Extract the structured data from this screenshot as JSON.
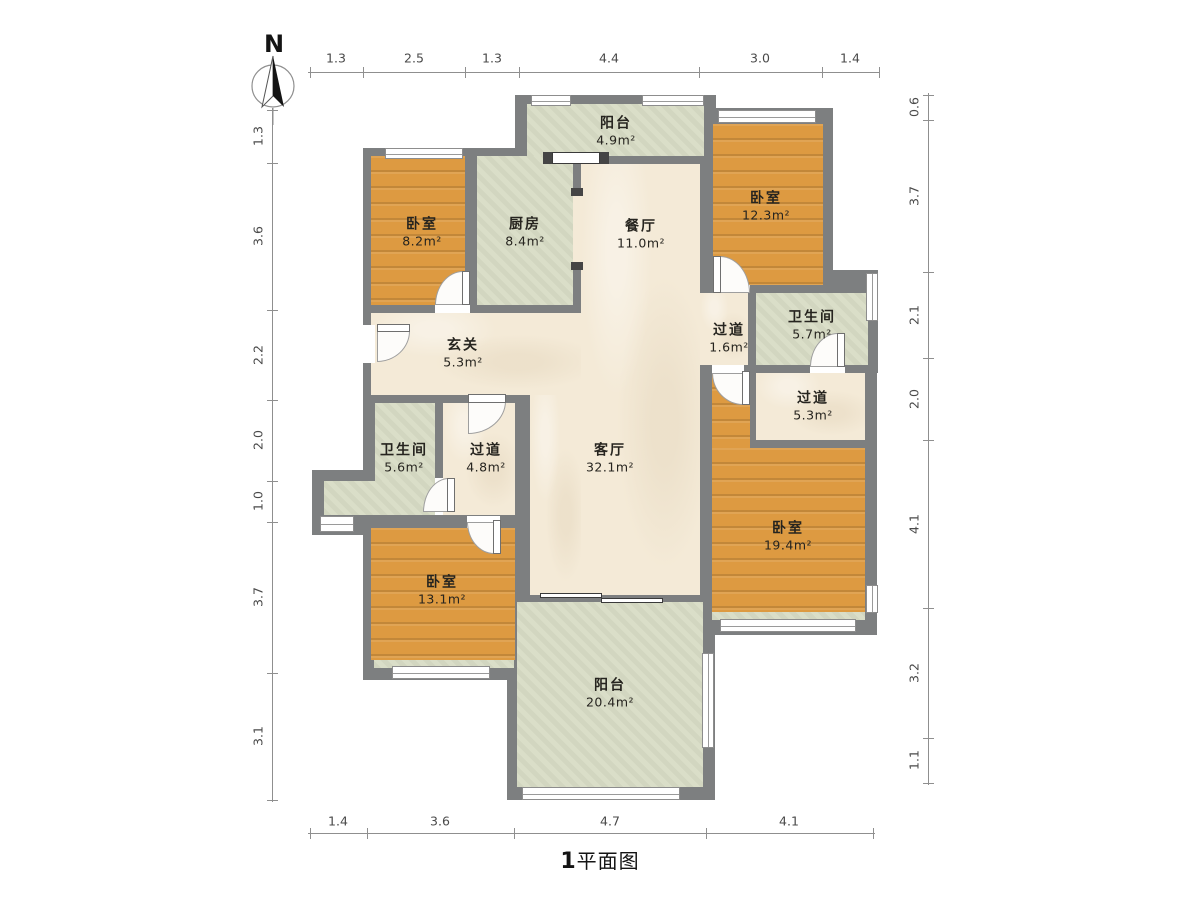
{
  "compass": {
    "label": "N"
  },
  "title": {
    "number": "1",
    "text": "平面图"
  },
  "dimensions": {
    "top": [
      "1.3",
      "2.5",
      "1.3",
      "4.4",
      "3.0",
      "1.4"
    ],
    "left": [
      "1.3",
      "3.6",
      "2.2",
      "2.0",
      "1.0",
      "3.7",
      "3.1"
    ],
    "right": [
      "0.6",
      "3.7",
      "2.1",
      "2.0",
      "4.1",
      "3.2",
      "1.1"
    ],
    "bottom": [
      "1.4",
      "3.6",
      "4.7",
      "4.1"
    ]
  },
  "rooms": [
    {
      "id": "balcony-top",
      "name": "阳台",
      "area": "4.9m²"
    },
    {
      "id": "bedroom-top-left",
      "name": "卧室",
      "area": "8.2m²"
    },
    {
      "id": "kitchen",
      "name": "厨房",
      "area": "8.4m²"
    },
    {
      "id": "dining",
      "name": "餐厅",
      "area": "11.0m²"
    },
    {
      "id": "bedroom-top-right",
      "name": "卧室",
      "area": "12.3m²"
    },
    {
      "id": "bathroom-right",
      "name": "卫生间",
      "area": "5.7m²"
    },
    {
      "id": "hallway-small",
      "name": "过道",
      "area": "1.6m²"
    },
    {
      "id": "entry",
      "name": "玄关",
      "area": "5.3m²"
    },
    {
      "id": "hallway-right",
      "name": "过道",
      "area": "5.3m²"
    },
    {
      "id": "bathroom-left",
      "name": "卫生间",
      "area": "5.6m²"
    },
    {
      "id": "hallway-left",
      "name": "过道",
      "area": "4.8m²"
    },
    {
      "id": "living",
      "name": "客厅",
      "area": "32.1m²"
    },
    {
      "id": "bedroom-right",
      "name": "卧室",
      "area": "19.4m²"
    },
    {
      "id": "bedroom-bottom-left",
      "name": "卧室",
      "area": "13.1m²"
    },
    {
      "id": "balcony-bottom",
      "name": "阳台",
      "area": "20.4m²"
    }
  ],
  "colors": {
    "wall": "#7d7f80",
    "wood_floor": "#dd9a41",
    "tile_floor": "#d9ddc6",
    "marble_floor": "#f4ead7",
    "dimension_text": "#4a4a4a",
    "label_text": "#26241f"
  }
}
